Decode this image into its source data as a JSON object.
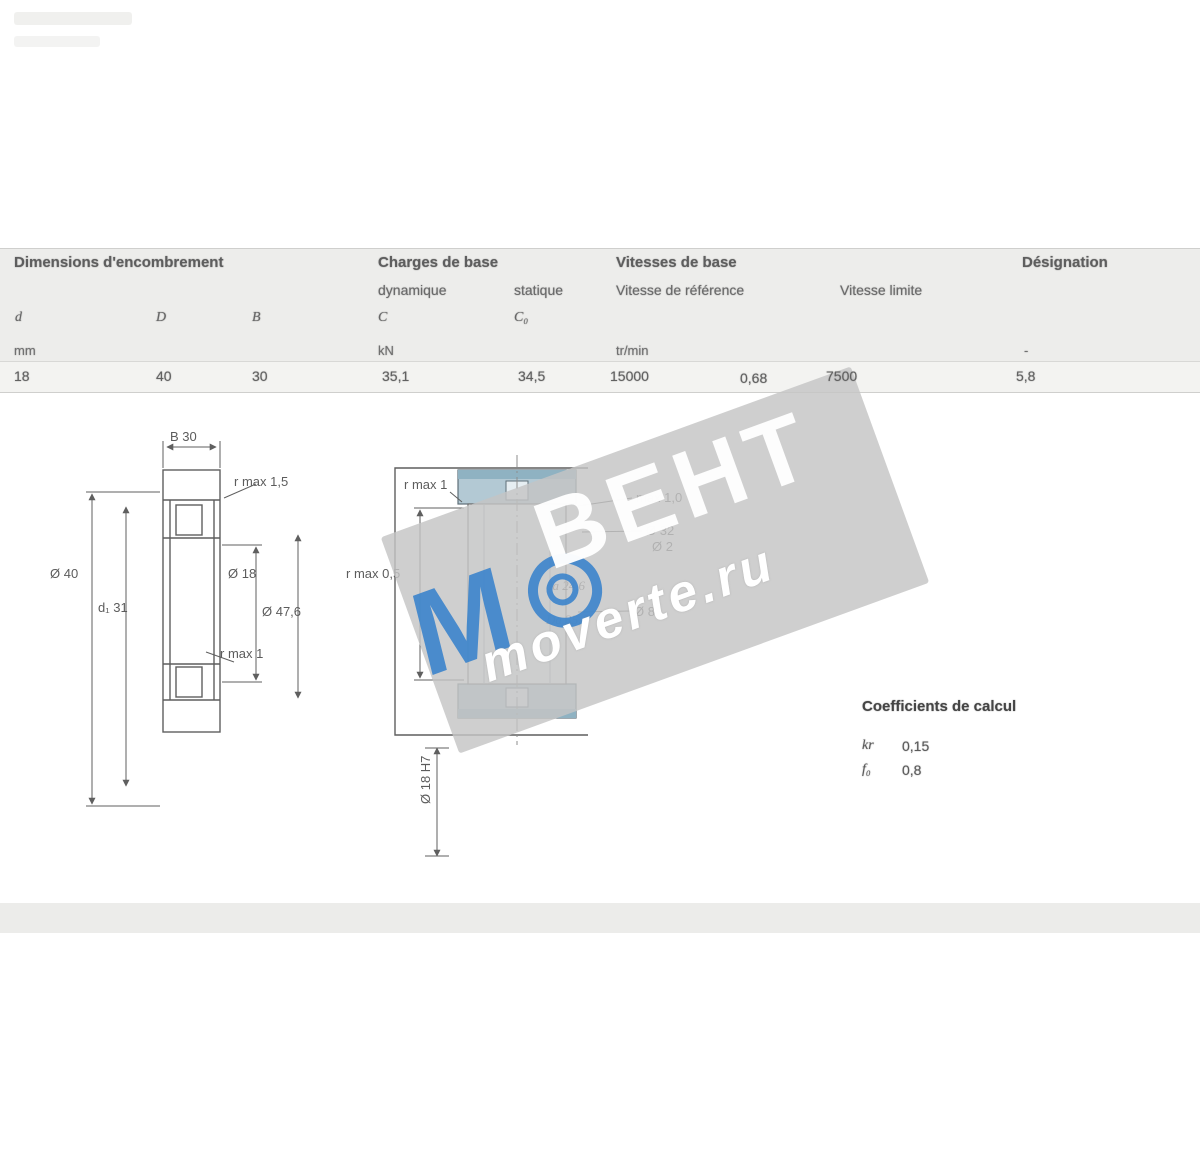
{
  "table": {
    "group_headers": [
      "Dimensions d'encombrement",
      "Charges de base",
      "Vitesses de base",
      "Désignation"
    ],
    "sub_headers": [
      "dynamique",
      "statique",
      "Vitesse de référence",
      "Vitesse limite"
    ],
    "symbols": [
      "d",
      "D",
      "B",
      "C",
      "C₀"
    ],
    "units": [
      "mm",
      "kN",
      "tr/min",
      "-"
    ],
    "row": [
      "18",
      "40",
      "30",
      "35,1",
      "34,5",
      "15000",
      "0,68",
      "7500",
      "5,8"
    ]
  },
  "drawing_left": {
    "labels": [
      "B 30",
      "r max 1,5",
      "Ø 40",
      "d₁ 31",
      "Ø 18",
      "Ø 47,6",
      "r max 1"
    ]
  },
  "drawing_center": {
    "labels": [
      "r max 1",
      "r max 0,5",
      "max 1,0",
      "Ø 32",
      "Ø 2",
      "Ø 8",
      "da 24,6",
      "Da 35,4",
      "Ø 18 H7"
    ]
  },
  "factors": {
    "title": "Coefficients de calcul",
    "lines": [
      {
        "sym": "kr",
        "val": "0,15"
      },
      {
        "sym": "f₀",
        "val": "0,8"
      }
    ]
  },
  "watermark": {
    "brand": "ВЕНТ",
    "site": "moverte.ru",
    "logo_letter": "M",
    "accent_color": "#3f86cc"
  }
}
